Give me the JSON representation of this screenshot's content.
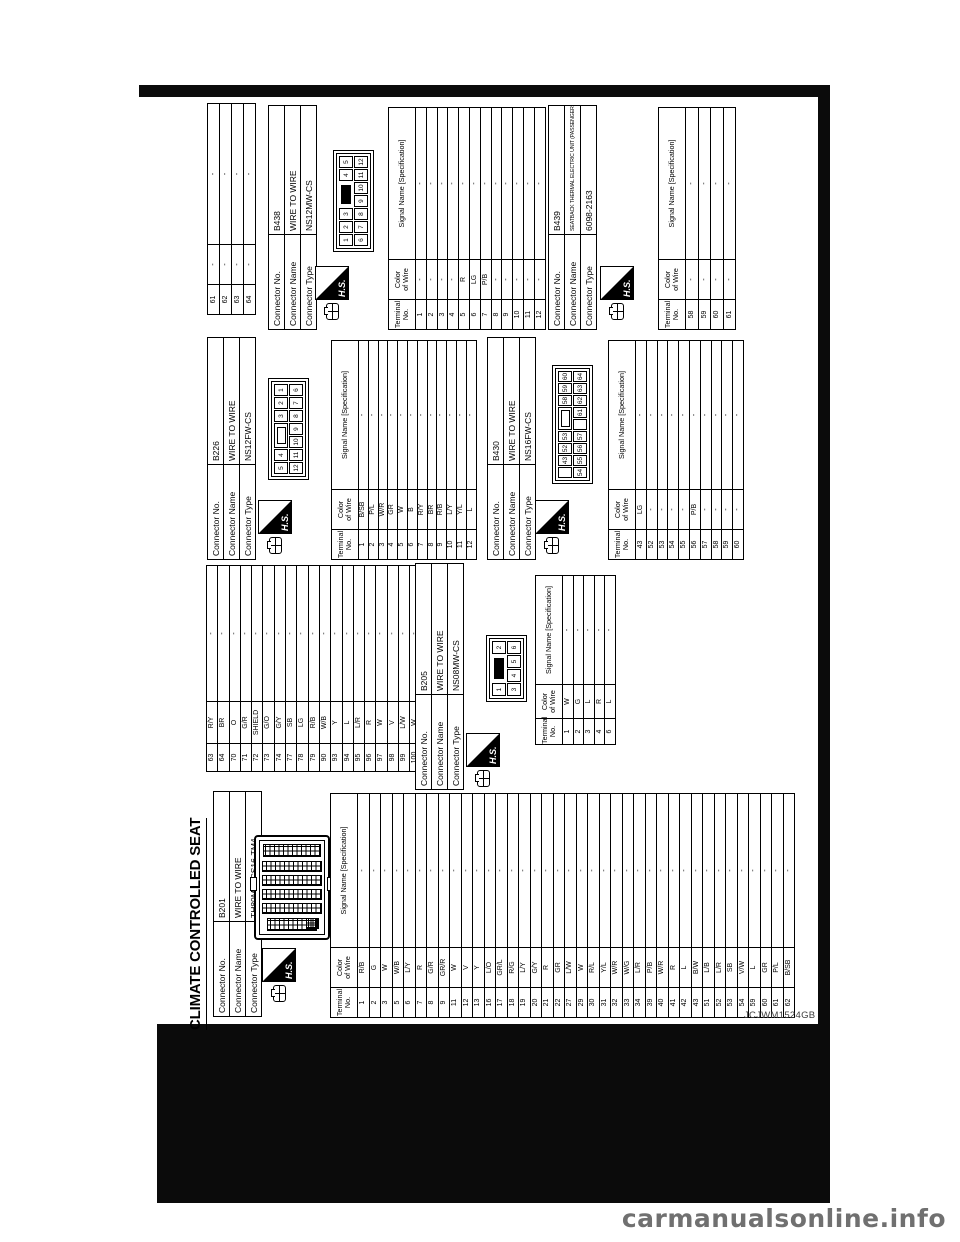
{
  "page": {
    "title": "CLIMATE CONTROLLED SEAT",
    "figure_id": "JCJWM1524GB",
    "watermark": "carmanualsonline.info",
    "hs_label": "H.S.",
    "labels": {
      "connector_no": "Connector No.",
      "connector_name": "Connector Name",
      "connector_type": "Connector Type",
      "terminal_no_1": "Terminal",
      "terminal_no_2": "No.",
      "color_1": "Color",
      "color_2": "of Wire",
      "signal": "Signal Name [Specification]"
    }
  },
  "connectors": {
    "b201": {
      "no": "B201",
      "name": "WIRE TO WIRE",
      "type": "TH80MW-CS16-TM4",
      "rows": [
        {
          "n": "1",
          "c": "R/B",
          "s": "-"
        },
        {
          "n": "2",
          "c": "G",
          "s": "-"
        },
        {
          "n": "3",
          "c": "W",
          "s": "-"
        },
        {
          "n": "5",
          "c": "W/B",
          "s": "-"
        },
        {
          "n": "6",
          "c": "L/Y",
          "s": "-"
        },
        {
          "n": "7",
          "c": "R",
          "s": "-"
        },
        {
          "n": "8",
          "c": "G/R",
          "s": "-"
        },
        {
          "n": "9",
          "c": "GR/R",
          "s": "-"
        },
        {
          "n": "11",
          "c": "W",
          "s": "-"
        },
        {
          "n": "12",
          "c": "V",
          "s": "-"
        },
        {
          "n": "13",
          "c": "Y",
          "s": "-"
        },
        {
          "n": "16",
          "c": "L/O",
          "s": "-"
        },
        {
          "n": "17",
          "c": "GR/L",
          "s": "-"
        },
        {
          "n": "18",
          "c": "R/G",
          "s": "-"
        },
        {
          "n": "19",
          "c": "L/Y",
          "s": "-"
        },
        {
          "n": "20",
          "c": "G/Y",
          "s": "-"
        },
        {
          "n": "21",
          "c": "R",
          "s": "-"
        },
        {
          "n": "22",
          "c": "GR",
          "s": "-"
        },
        {
          "n": "27",
          "c": "L/W",
          "s": "-"
        },
        {
          "n": "29",
          "c": "W",
          "s": "-"
        },
        {
          "n": "30",
          "c": "R/L",
          "s": "-"
        },
        {
          "n": "31",
          "c": "Y/L",
          "s": "-"
        },
        {
          "n": "32",
          "c": "W/R",
          "s": "-"
        },
        {
          "n": "33",
          "c": "W/G",
          "s": "-"
        },
        {
          "n": "34",
          "c": "L/R",
          "s": "-"
        },
        {
          "n": "39",
          "c": "P/B",
          "s": "-"
        },
        {
          "n": "40",
          "c": "W/R",
          "s": "-"
        },
        {
          "n": "41",
          "c": "R",
          "s": "-"
        },
        {
          "n": "42",
          "c": "L",
          "s": "-"
        },
        {
          "n": "43",
          "c": "B/W",
          "s": "-"
        },
        {
          "n": "51",
          "c": "L/B",
          "s": "-"
        },
        {
          "n": "52",
          "c": "L/R",
          "s": "-"
        },
        {
          "n": "53",
          "c": "SB",
          "s": "-"
        },
        {
          "n": "54",
          "c": "V/W",
          "s": "-"
        },
        {
          "n": "59",
          "c": "L",
          "s": "-"
        },
        {
          "n": "60",
          "c": "GR",
          "s": "-"
        },
        {
          "n": "61",
          "c": "P/L",
          "s": "-"
        },
        {
          "n": "62",
          "c": "B/SB",
          "s": "-"
        }
      ],
      "cont": [
        {
          "n": "63",
          "c": "R/Y",
          "s": "-"
        },
        {
          "n": "64",
          "c": "BR",
          "s": "-"
        },
        {
          "n": "70",
          "c": "O",
          "s": "-"
        },
        {
          "n": "71",
          "c": "G/R",
          "s": "-"
        },
        {
          "n": "72",
          "c": "SHIELD",
          "s": "-"
        },
        {
          "n": "73",
          "c": "G/O",
          "s": "-"
        },
        {
          "n": "74",
          "c": "G/Y",
          "s": "-"
        },
        {
          "n": "77",
          "c": "SB",
          "s": "-"
        },
        {
          "n": "78",
          "c": "LG",
          "s": "-"
        },
        {
          "n": "79",
          "c": "R/B",
          "s": "-"
        },
        {
          "n": "90",
          "c": "W/B",
          "s": "-"
        },
        {
          "n": "93",
          "c": "Y",
          "s": "-"
        },
        {
          "n": "94",
          "c": "L",
          "s": "-"
        },
        {
          "n": "95",
          "c": "L/R",
          "s": "-"
        },
        {
          "n": "96",
          "c": "R",
          "s": "-"
        },
        {
          "n": "97",
          "c": "W",
          "s": "-"
        },
        {
          "n": "98",
          "c": "V",
          "s": "-"
        },
        {
          "n": "99",
          "c": "L/W",
          "s": "-"
        },
        {
          "n": "100",
          "c": "W",
          "s": "-"
        }
      ]
    },
    "b205": {
      "no": "B205",
      "name": "WIRE TO WIRE",
      "type": "NS08MW-CS",
      "pins_top": [
        "1",
        "#B",
        "2"
      ],
      "pins_bottom": [
        "3",
        "4",
        "5",
        "6"
      ],
      "rows": [
        {
          "n": "1",
          "c": "W",
          "s": "-"
        },
        {
          "n": "2",
          "c": "G",
          "s": "-"
        },
        {
          "n": "3",
          "c": "L",
          "s": "-"
        },
        {
          "n": "4",
          "c": "R",
          "s": "-"
        },
        {
          "n": "6",
          "c": "L",
          "s": "-"
        }
      ]
    },
    "b226": {
      "no": "B226",
      "name": "WIRE TO WIRE",
      "type": "NS12FW-CS",
      "pins_top": [
        "5",
        "4",
        "#W",
        "3",
        "2",
        "1"
      ],
      "pins_bottom": [
        "12",
        "11",
        "10",
        "9",
        "8",
        "7",
        "6"
      ],
      "rows": [
        {
          "n": "1",
          "c": "B/SB",
          "s": "-"
        },
        {
          "n": "2",
          "c": "P/L",
          "s": "-"
        },
        {
          "n": "3",
          "c": "W/R",
          "s": "-"
        },
        {
          "n": "4",
          "c": "GR",
          "s": "-"
        },
        {
          "n": "5",
          "c": "W",
          "s": "-"
        },
        {
          "n": "6",
          "c": "B",
          "s": "-"
        },
        {
          "n": "7",
          "c": "R/Y",
          "s": "-"
        },
        {
          "n": "8",
          "c": "BR",
          "s": "-"
        },
        {
          "n": "9",
          "c": "R/B",
          "s": "-"
        },
        {
          "n": "10",
          "c": "L/Y",
          "s": "-"
        },
        {
          "n": "11",
          "c": "Y/L",
          "s": "-"
        },
        {
          "n": "12",
          "c": "L",
          "s": "-"
        }
      ]
    },
    "b430": {
      "no": "B430",
      "name": "WIRE TO WIRE",
      "type": "NS16FW-CS",
      "pins_top": [
        "",
        "43",
        "52",
        "53",
        "#W",
        "58",
        "59",
        "60"
      ],
      "pins_bottom": [
        "54",
        "55",
        "56",
        "57",
        "",
        "61",
        "62",
        "63",
        "64"
      ],
      "rows": [
        {
          "n": "43",
          "c": "LG",
          "s": "-"
        },
        {
          "n": "52",
          "c": "-",
          "s": "-"
        },
        {
          "n": "53",
          "c": "-",
          "s": "-"
        },
        {
          "n": "54",
          "c": "-",
          "s": "-"
        },
        {
          "n": "55",
          "c": "-",
          "s": "-"
        },
        {
          "n": "56",
          "c": "P/B",
          "s": "-"
        },
        {
          "n": "57",
          "c": "-",
          "s": "-"
        },
        {
          "n": "58",
          "c": "-",
          "s": "-"
        },
        {
          "n": "59",
          "c": "-",
          "s": "-"
        },
        {
          "n": "60",
          "c": "-",
          "s": "-"
        }
      ],
      "cont": [
        {
          "n": "61",
          "c": "-",
          "s": "-"
        },
        {
          "n": "62",
          "c": "-",
          "s": "-"
        },
        {
          "n": "63",
          "c": "-",
          "s": "-"
        },
        {
          "n": "64",
          "c": "-",
          "s": "-"
        }
      ]
    },
    "b438": {
      "no": "B438",
      "name": "WIRE TO WIRE",
      "type": "NS12MW-CS",
      "pins_top": [
        "1",
        "2",
        "3",
        "#B",
        "4",
        "5"
      ],
      "pins_bottom": [
        "6",
        "7",
        "8",
        "9",
        "10",
        "11",
        "12"
      ],
      "rows": [
        {
          "n": "1",
          "c": "-",
          "s": "-"
        },
        {
          "n": "2",
          "c": "-",
          "s": "-"
        },
        {
          "n": "3",
          "c": "-",
          "s": "-"
        },
        {
          "n": "4",
          "c": "-",
          "s": "-"
        },
        {
          "n": "5",
          "c": "R",
          "s": "-"
        },
        {
          "n": "6",
          "c": "LG",
          "s": "-"
        },
        {
          "n": "7",
          "c": "P/B",
          "s": "-"
        },
        {
          "n": "8",
          "c": "-",
          "s": "-"
        },
        {
          "n": "9",
          "c": "-",
          "s": "-"
        },
        {
          "n": "10",
          "c": "-",
          "s": "-"
        },
        {
          "n": "11",
          "c": "-",
          "s": "-"
        },
        {
          "n": "12",
          "c": "-",
          "s": "-"
        }
      ]
    },
    "b439": {
      "no": "B439",
      "name": "SEATBACK THERMAL ELECTRIC UNIT (PASSENGER SIDE)",
      "type": "6098-2163",
      "pins": [
        "61",
        "60",
        "59",
        "58"
      ],
      "rows": [
        {
          "n": "58",
          "c": "-",
          "s": "-"
        },
        {
          "n": "59",
          "c": "-",
          "s": "-"
        },
        {
          "n": "60",
          "c": "-",
          "s": "-"
        },
        {
          "n": "61",
          "c": "-",
          "s": "-"
        }
      ]
    }
  }
}
